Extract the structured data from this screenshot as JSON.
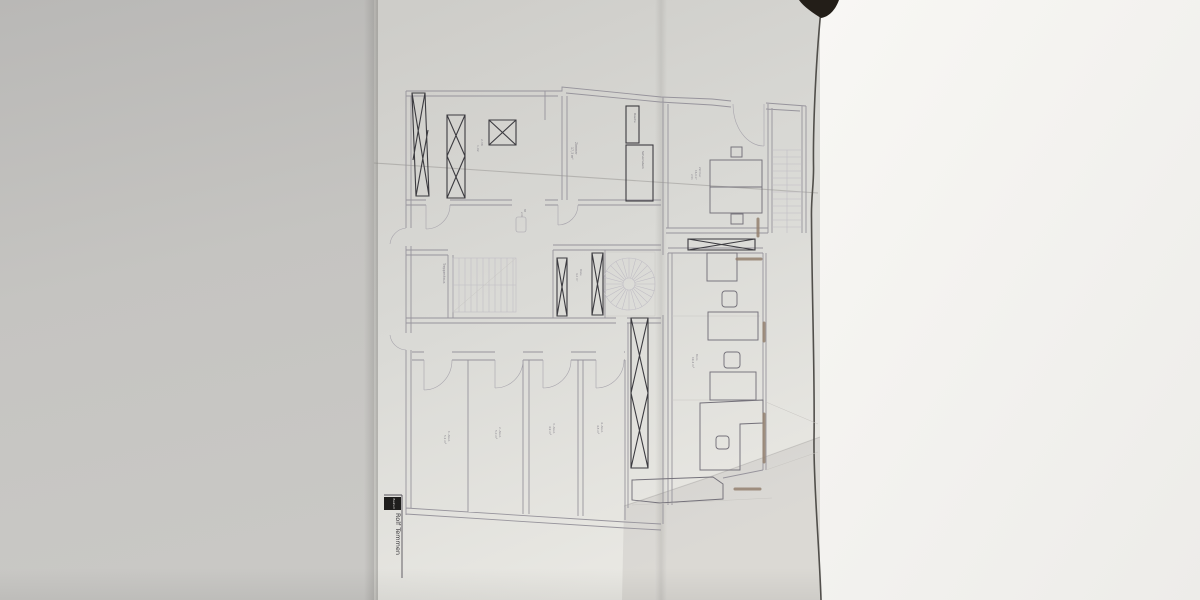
{
  "colors": {
    "background": "#c3c2c0",
    "paper": "#d8d7d3",
    "paper_light": "#e9e8e3",
    "right_surface": "#f6f5f2",
    "wall": "#97949c",
    "furniture": "#3c3b40",
    "marker": "#93806f",
    "paper_edge": "#514f4b",
    "corner_shadow": "#231e18"
  },
  "title_block": {
    "header": "Bauherr",
    "name": "Rolf Temmen"
  },
  "plan_labels": {
    "topleft_dim": {
      "lines": [
        "2,38",
        "1,02"
      ]
    },
    "room_top_mid": {
      "lines": [
        "Zimmer",
        "17,3 m²"
      ]
    },
    "duct_small": {
      "lines": [
        "Dusche"
      ]
    },
    "duct_big": {
      "lines": [
        "Schornstein"
      ]
    },
    "bedroom": {
      "lines": [
        "Zimmer",
        "16,9 m²",
        "2,51"
      ]
    },
    "office": {
      "lines": [
        "Büro",
        "19,4 m²"
      ]
    },
    "stairhall": {
      "lines": [
        "Treppenhaus"
      ]
    },
    "diele": {
      "lines": [
        "Diele",
        "4,2 m²"
      ]
    },
    "door_dim": {
      "lines": [
        "88",
        "2,01"
      ]
    },
    "store1": {
      "lines": [
        "1. Abst.",
        "5,1 m²"
      ]
    },
    "store2": {
      "lines": [
        "2. Abst.",
        "5,0 m²"
      ]
    },
    "store3": {
      "lines": [
        "3. Abst.",
        "4,9 m²"
      ]
    },
    "store4": {
      "lines": [
        "4. Abst.",
        "4,8 m²"
      ]
    }
  }
}
